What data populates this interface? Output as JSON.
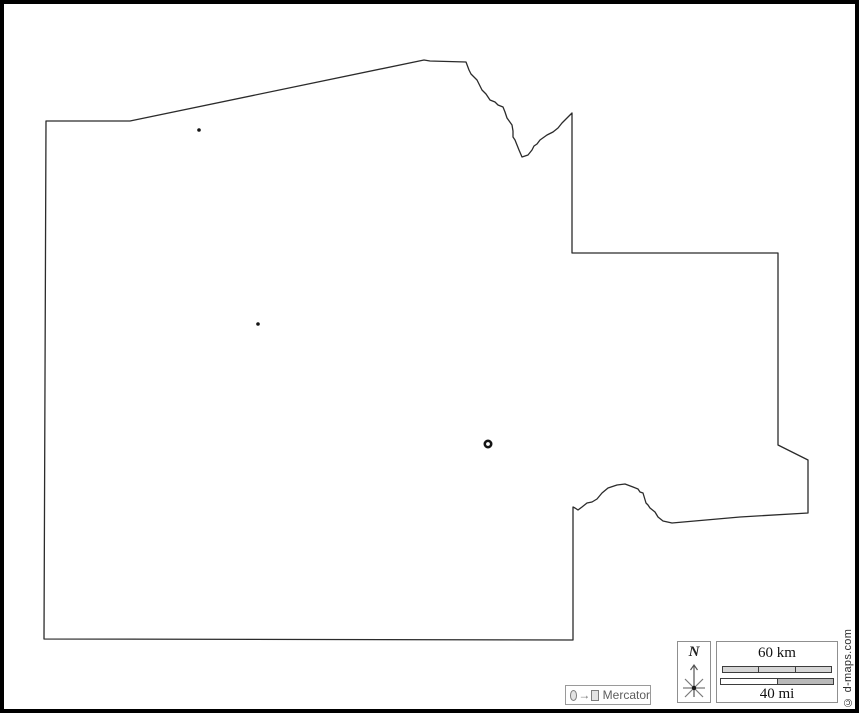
{
  "map": {
    "background_color": "#ffffff",
    "outline_color": "#2b2b2b",
    "outline_stroke_width": 1.3,
    "outline_points": [
      [
        46,
        121
      ],
      [
        130,
        121
      ],
      [
        424,
        60
      ],
      [
        430,
        61
      ],
      [
        466,
        62
      ],
      [
        469,
        70
      ],
      [
        471,
        74
      ],
      [
        477,
        80
      ],
      [
        479,
        84
      ],
      [
        482,
        90
      ],
      [
        486,
        94
      ],
      [
        490,
        100
      ],
      [
        495,
        102
      ],
      [
        498,
        105
      ],
      [
        503,
        107
      ],
      [
        505,
        112
      ],
      [
        507,
        118
      ],
      [
        512,
        125
      ],
      [
        513,
        131
      ],
      [
        513,
        137
      ],
      [
        515,
        140
      ],
      [
        519,
        150
      ],
      [
        522,
        157
      ],
      [
        528,
        155
      ],
      [
        532,
        150
      ],
      [
        534,
        146
      ],
      [
        537,
        144
      ],
      [
        540,
        140
      ],
      [
        547,
        135
      ],
      [
        553,
        132
      ],
      [
        558,
        128
      ],
      [
        562,
        123
      ],
      [
        565,
        120
      ],
      [
        568,
        117
      ],
      [
        572,
        113
      ],
      [
        572,
        253
      ],
      [
        778,
        253
      ],
      [
        778,
        445
      ],
      [
        808,
        460
      ],
      [
        808,
        513
      ],
      [
        740,
        517
      ],
      [
        672,
        523
      ],
      [
        663,
        521
      ],
      [
        658,
        517
      ],
      [
        655,
        512
      ],
      [
        650,
        508
      ],
      [
        648,
        505
      ],
      [
        646,
        503
      ],
      [
        643,
        493
      ],
      [
        640,
        492
      ],
      [
        638,
        489
      ],
      [
        633,
        487
      ],
      [
        625,
        484
      ],
      [
        617,
        485
      ],
      [
        608,
        488
      ],
      [
        602,
        493
      ],
      [
        597,
        499
      ],
      [
        592,
        502
      ],
      [
        587,
        503
      ],
      [
        582,
        507
      ],
      [
        578,
        510
      ],
      [
        575,
        508
      ],
      [
        573,
        507
      ],
      [
        573,
        640
      ],
      [
        44,
        639
      ]
    ],
    "markers": [
      {
        "type": "city-dot",
        "x": 199,
        "y": 130,
        "r": 1.8
      },
      {
        "type": "city-dot",
        "x": 258,
        "y": 324,
        "r": 1.8
      },
      {
        "type": "capital-ring",
        "x": 488,
        "y": 444,
        "r": 3.2
      }
    ],
    "marker_color": "#141414"
  },
  "compass": {
    "label": "N"
  },
  "scale_bar": {
    "km_label": "60 km",
    "mi_label": "40 mi",
    "km_segments": 3,
    "mi_segments": 2
  },
  "projection": {
    "label": "Mercator"
  },
  "copyright": "© d-maps.com"
}
